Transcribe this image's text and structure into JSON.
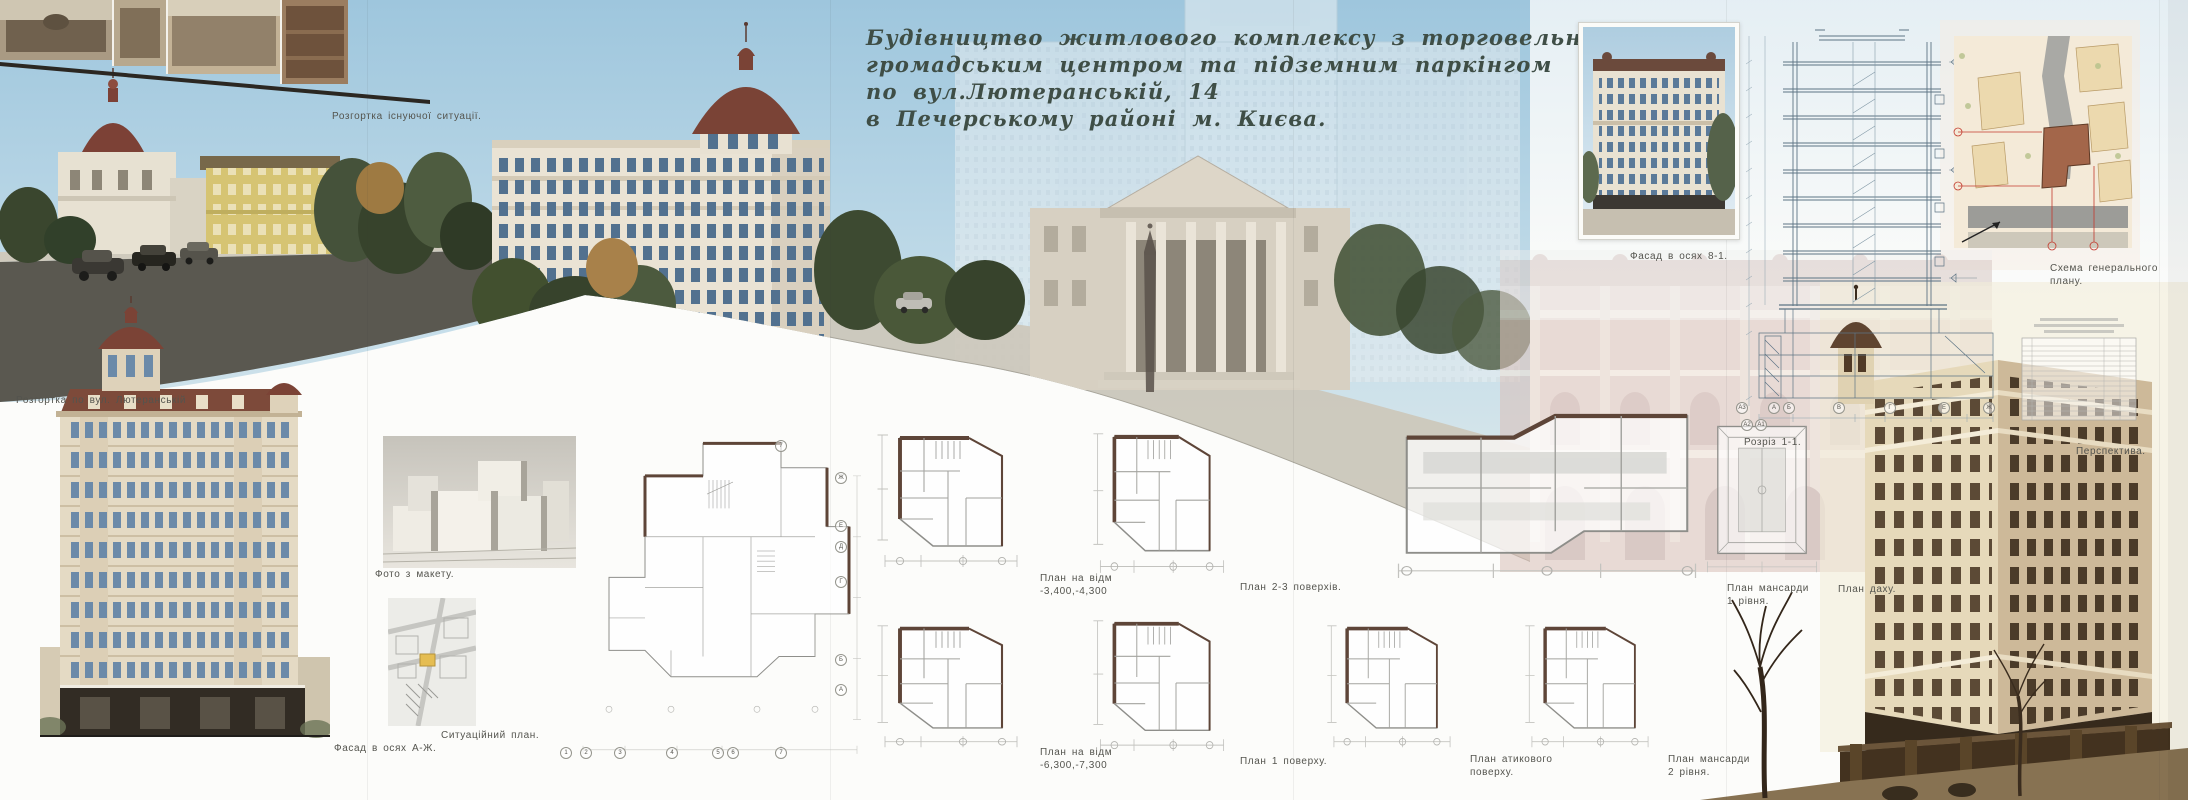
{
  "title": {
    "lines": [
      "Будівництво житлового комплексу з торговельно-",
      "громадським центром та підземним паркінгом",
      "по вул.Лютеранській, 14",
      "в Печерському районі м. Києва."
    ]
  },
  "captions": {
    "existing_situation": "Розгортка існуючої ситуації.",
    "street_panorama": "Розгортка по вул. Лютеранській",
    "facade_a_zh": "Фасад в осях А-Ж.",
    "model_photo": "Фото з макету.",
    "situation_plan": "Ситуаційний план.",
    "facade_8_1": "Фасад в осях 8-1.",
    "section_1_1": "Розріз 1-1.",
    "master_plan": [
      "Схема генерального",
      "плану."
    ],
    "perspective": "Перспектива."
  },
  "floor_plans": [
    {
      "id": "basement-upper",
      "caption": [
        "План на відм",
        "-3,400,-4,300"
      ]
    },
    {
      "id": "floors-2-3",
      "caption": [
        "План 2-3 поверхів."
      ]
    },
    {
      "id": "mansard-1",
      "caption": [
        "План мансарди",
        "1 рівня."
      ]
    },
    {
      "id": "roof",
      "caption": [
        "План даху."
      ]
    },
    {
      "id": "basement-lower",
      "caption": [
        "План на відм",
        "-6,300,-7,300"
      ]
    },
    {
      "id": "floor-1",
      "caption": [
        "План 1 поверху."
      ]
    },
    {
      "id": "attic",
      "caption": [
        "План атикового",
        "поверху."
      ]
    },
    {
      "id": "mansard-2",
      "caption": [
        "План мансарди",
        "2 рівня."
      ]
    }
  ],
  "axes": {
    "large_plan_bottom": [
      "1",
      "2",
      "3",
      "4",
      "5",
      "6",
      "7"
    ],
    "large_plan_side": [
      "Ж",
      "Е",
      "Д",
      "Г",
      "Б",
      "А"
    ],
    "section_bottom": [
      "А3",
      "А",
      "Б",
      "В",
      "Г",
      "Е",
      "Ж"
    ],
    "section_bottom_sub": [
      "А2",
      "А1"
    ]
  },
  "colors": {
    "sky": "#a3cadf",
    "title_ink": "#3f4e46",
    "sepia_photo": "#b3a085",
    "dome_red": "#7b4336",
    "plan_wall_brown": "#5e4538",
    "render_brown": "#6b4a32",
    "site_building_beige": "#ecd9ae",
    "site_road_gray": "#a3a3a1",
    "dimension_red": "#c23a2e"
  }
}
